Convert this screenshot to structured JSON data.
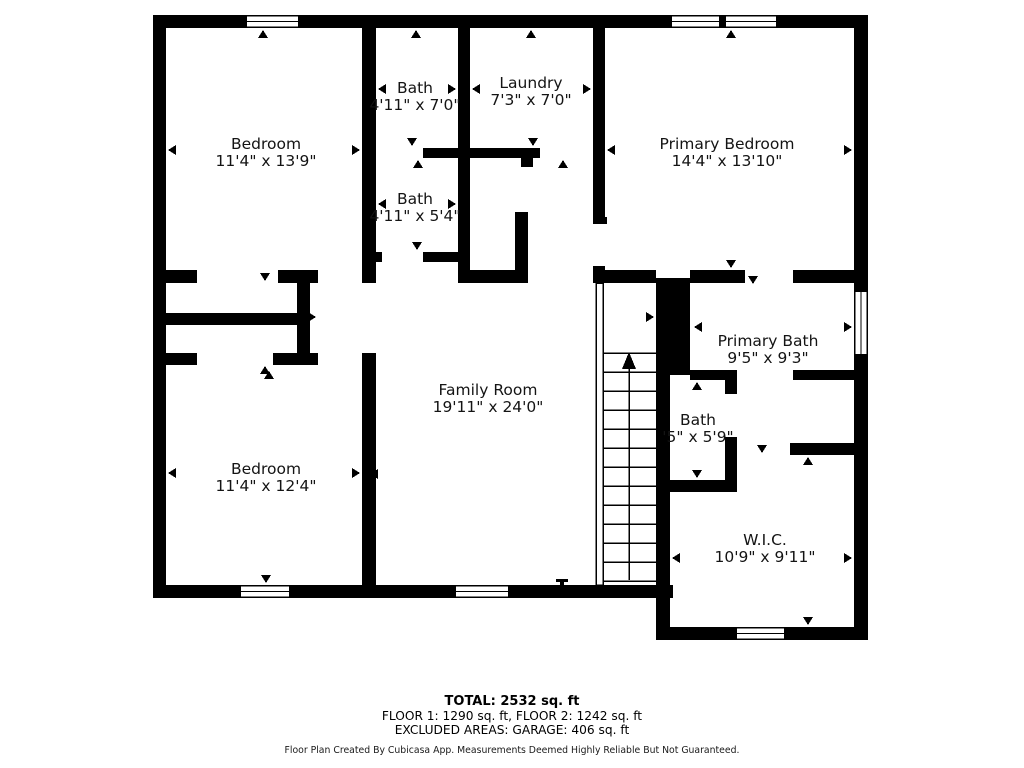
{
  "floor_plan": {
    "rooms": [
      {
        "name": "Bedroom",
        "dims": "11'4\" x 13'9\""
      },
      {
        "name": "Bath",
        "dims": "4'11\" x 7'0\""
      },
      {
        "name": "Laundry",
        "dims": "7'3\" x 7'0\""
      },
      {
        "name": "Primary Bedroom",
        "dims": "14'4\" x 13'10\""
      },
      {
        "name": "Bath",
        "dims": "4'11\" x 5'4\""
      },
      {
        "name": "Family Room",
        "dims": "19'11\" x 24'0\""
      },
      {
        "name": "Primary Bath",
        "dims": "9'5\" x 9'3\""
      },
      {
        "name": "Bath",
        "dims": "'5\" x 5'9\""
      },
      {
        "name": "Bedroom",
        "dims": "11'4\" x 12'4\""
      },
      {
        "name": "W.I.C.",
        "dims": "10'9\" x 9'11\""
      }
    ],
    "summary": {
      "total": "TOTAL: 2532 sq. ft",
      "floors": "FLOOR 1: 1290 sq. ft, FLOOR 2: 1242 sq. ft",
      "excluded": "EXCLUDED AREAS: GARAGE: 406 sq. ft",
      "disclaimer": "Floor Plan Created By Cubicasa App. Measurements Deemed Highly Reliable But Not Guaranteed."
    },
    "colors": {
      "wall": "#000000",
      "background": "#ffffff",
      "text": "#141414"
    }
  }
}
